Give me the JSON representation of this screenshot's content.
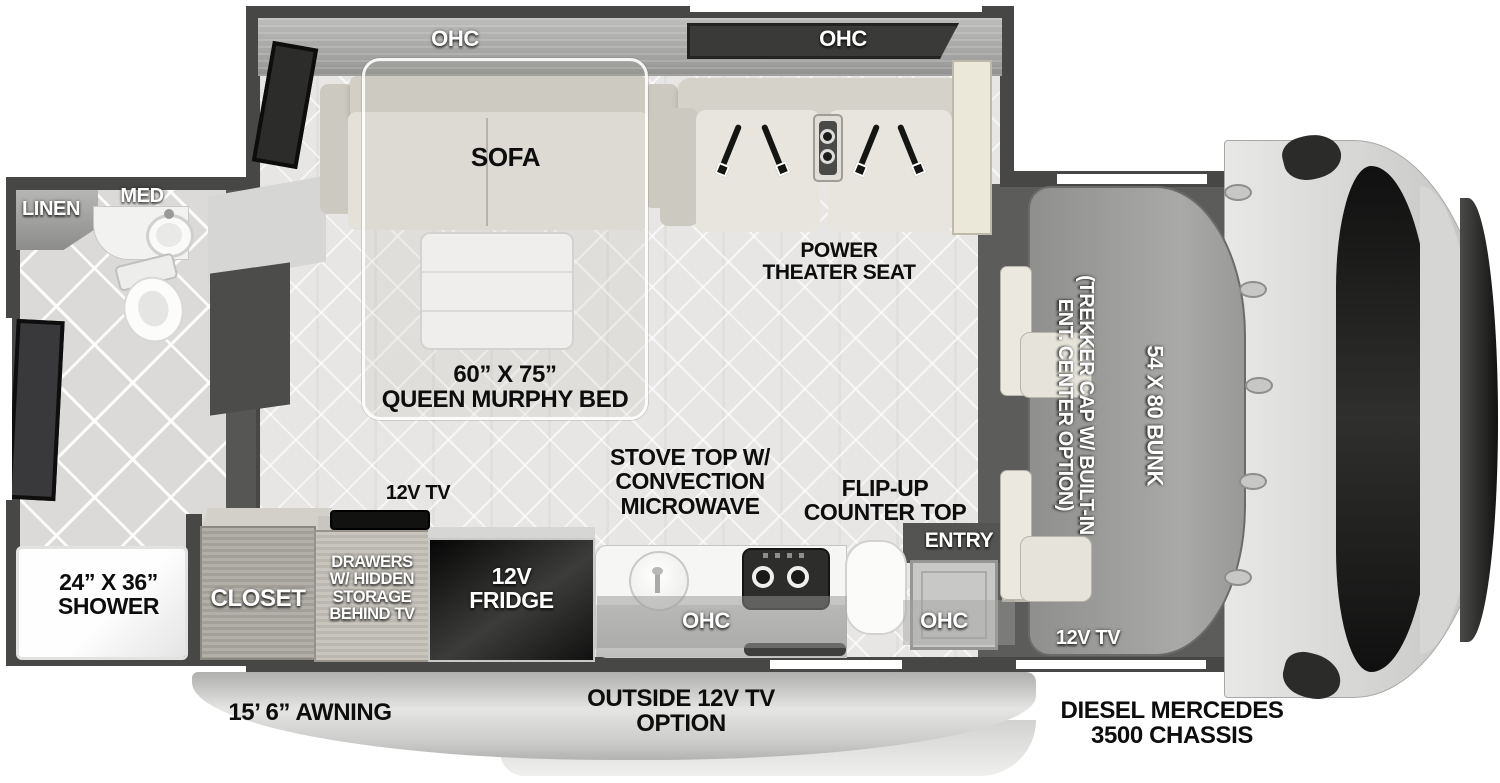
{
  "colors": {
    "wall": "#474745",
    "floor": "#e7e6e4",
    "cab_floor": "#5c5c5a",
    "fridge": "#111111",
    "ohc_panel": "#3a3a38",
    "awning": "#d9d9d7"
  },
  "slideout": {
    "ohc_left": "OHC",
    "ohc_right": "OHC",
    "sofa": "SOFA",
    "theater_lines": [
      "POWER",
      "THEATER SEAT"
    ],
    "murphy_lines": [
      "60” X 75”",
      "QUEEN MURPHY BED"
    ]
  },
  "bathroom": {
    "linen": "LINEN",
    "med": "MED",
    "shower_lines": [
      "24” X 36”",
      "SHOWER"
    ]
  },
  "kitchen": {
    "tv": "12V TV",
    "stove_lines": [
      "STOVE TOP W/",
      "CONVECTION",
      "MICROWAVE"
    ],
    "flip_lines": [
      "FLIP-UP",
      "COUNTER TOP"
    ],
    "entry": "ENTRY",
    "ohc_counter": "OHC",
    "ohc_entry": "OHC",
    "closet": "CLOSET",
    "drawers_lines": [
      "DRAWERS",
      "W/ HIDDEN",
      "STORAGE",
      "BEHIND TV"
    ],
    "fridge_lines": [
      "12V",
      "FRIDGE"
    ]
  },
  "cab": {
    "trekker_lines": [
      "(TREKKER CAP W/ BUILT-IN",
      "ENT. CENTER OPTION)"
    ],
    "bunk": "54 X 80 BUNK",
    "tv": "12V TV",
    "chassis_lines": [
      "DIESEL MERCEDES",
      "3500 CHASSIS"
    ]
  },
  "exterior": {
    "awning": "15’ 6” AWNING",
    "outside_tv_lines": [
      "OUTSIDE 12V TV",
      "OPTION"
    ]
  }
}
